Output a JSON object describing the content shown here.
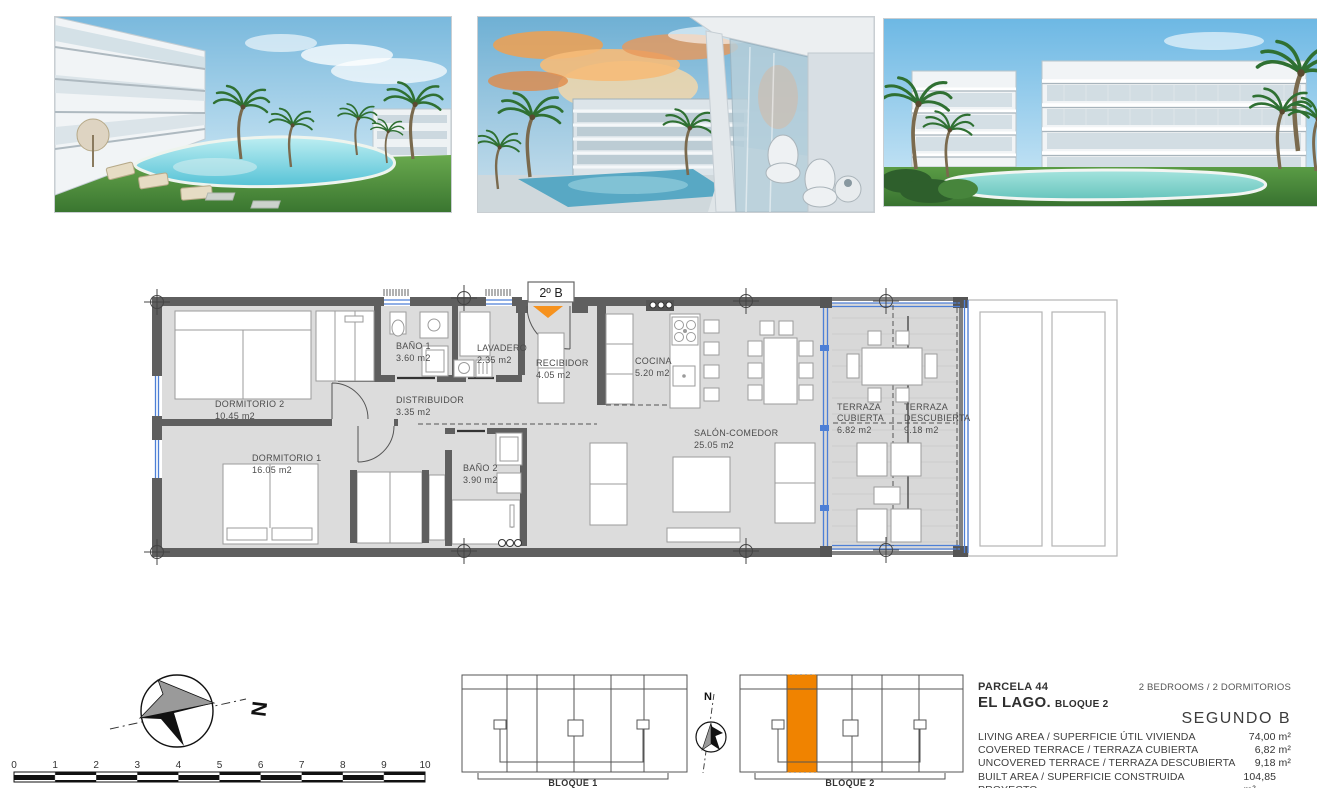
{
  "colors": {
    "wall_gray": "#5f5f5f",
    "floor_gray": "#dcdcdc",
    "window_blue": "#4d7fd6",
    "accent_orange": "#F6921E",
    "block_orange": "#F08300"
  },
  "gallery": {
    "photos": [
      {
        "name": "render-garden-pool-view"
      },
      {
        "name": "render-terrace-sunset-view"
      },
      {
        "name": "render-building-facade-pool"
      }
    ]
  },
  "floorplan": {
    "unit_badge": "2º B",
    "rooms": [
      {
        "lines": [
          "DORMITORIO 2"
        ],
        "area": "10.45 m2"
      },
      {
        "lines": [
          "DORMITORIO 1"
        ],
        "area": "16.05 m2"
      },
      {
        "lines": [
          "BAÑO 1"
        ],
        "area": "3.60 m2"
      },
      {
        "lines": [
          "LAVADERO"
        ],
        "area": "2.35 m2"
      },
      {
        "lines": [
          "RECIBIDOR"
        ],
        "area": "4.05 m2"
      },
      {
        "lines": [
          "DISTRIBUIDOR"
        ],
        "area": "3.35 m2"
      },
      {
        "lines": [
          "BAÑO 2"
        ],
        "area": "3.90 m2"
      },
      {
        "lines": [
          "COCINA"
        ],
        "area": "5.20 m2"
      },
      {
        "lines": [
          "SALÓN-COMEDOR"
        ],
        "area": "25.05 m2"
      },
      {
        "lines": [
          "TERRAZA",
          "CUBIERTA"
        ],
        "area": "6.82 m2"
      },
      {
        "lines": [
          "TERRAZA",
          "DESCUBIERTA"
        ],
        "area": "9.18 m2"
      }
    ]
  },
  "scale_bar": {
    "ticks": [
      "0",
      "1",
      "2",
      "3",
      "4",
      "5",
      "6",
      "7",
      "8",
      "9",
      "10"
    ]
  },
  "compass_main": {
    "label": "N"
  },
  "compass_small": {
    "label": "N"
  },
  "blocks": [
    {
      "label": "BLOQUE 1"
    },
    {
      "label": "BLOQUE 2"
    }
  ],
  "info": {
    "parcel": "PARCELA 44",
    "bedrooms": "2 BEDROOMS / 2 DORMITORIOS",
    "project_name": "EL LAGO.",
    "project_block": "BLOQUE 2",
    "unit_name": "SEGUNDO B",
    "areas": [
      {
        "label": "LIVING AREA / SUPERFICIE ÚTIL VIVIENDA",
        "value": "74,00 m²"
      },
      {
        "label": "COVERED TERRACE / TERRAZA CUBIERTA",
        "value": "6,82 m²"
      },
      {
        "label": "UNCOVERED TERRACE / TERRAZA DESCUBIERTA",
        "value": "9,18 m²"
      },
      {
        "label": "BUILT AREA / SUPERFICIE CONSTRUIDA PROYECTO",
        "value": "104,85 m²"
      }
    ]
  }
}
